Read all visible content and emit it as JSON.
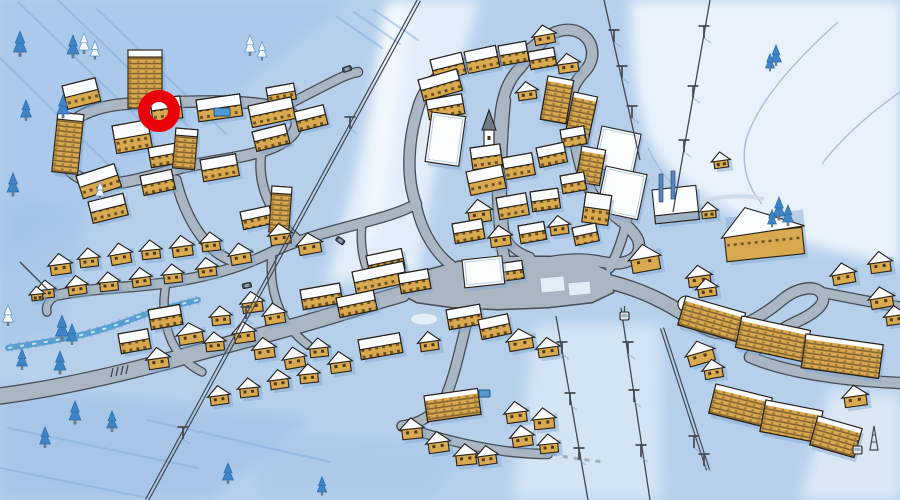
{
  "scene": {
    "width": 900,
    "height": 500,
    "kind": "illustrated-ski-resort-village-map"
  },
  "palette": {
    "snow_base": "#b6d0ec",
    "snow_light": "#e8f1fb",
    "snow_bright": "#f7fbff",
    "wash_dark": "#9fc1e6",
    "streak": "#84add9",
    "boundary": "#a2b8d0",
    "road_fill": "#aab6c2",
    "road_casing": "#41464d",
    "plaza_white": "#e2ecf5",
    "wall": "#d9a94f",
    "wall_dark": "#8a6426",
    "roof": "#fbfdff",
    "outline": "#262019",
    "shadow": "#7fa3cf",
    "window": "#4a3517",
    "floorline": "#47351a",
    "tree_blue": "#3d85c6",
    "tree_white": "#f4f9fe",
    "tree_edge": "#5b93c8",
    "water": "#4f9ad2",
    "water_bank": "#8d99a5",
    "lift": "#43474e",
    "post_blue": "#5585c2",
    "marker_red": "#e90008",
    "cone": "#e2a63e",
    "spire": "#707b88",
    "car": "#3e4a57"
  },
  "marker": {
    "cx": 159,
    "cy": 111,
    "ring_r": 15,
    "ring_w": 12
  },
  "washes": [
    {
      "d": "M620,0 H900 V265 C830,252 770,236 733,214 C697,192 668,176 652,146 C638,118 630,55 630,0 Z",
      "f": "#ecf4fc",
      "o": 0.95
    },
    {
      "d": "M388,0 H480 C462,62 444,120 434,178 C427,220 422,252 418,278 L326,284 C342,228 358,162 370,102 C376,66 383,30 388,0 Z",
      "f": "#e8f1fb",
      "o": 0.9
    },
    {
      "d": "M408,6 C402,70 392,150 380,220 L360,250 C370,170 380,80 386,6 Z",
      "f": "#f7fbff",
      "o": 0.8
    },
    {
      "d": "M535,325 L660,325 L662,500 L512,500 Z",
      "f": "#ddebf8",
      "o": 0.75
    },
    {
      "d": "M830,390 L900,395 L900,500 L800,500 Z",
      "f": "#e4eff9",
      "o": 0.8
    },
    {
      "d": "M0,0 L350,0 L140,170 L0,270 Z",
      "f": "#a4c5e9",
      "o": 0.6
    },
    {
      "d": "M0,195 L90,210 L60,330 L0,350 Z",
      "f": "#9fc1e6",
      "o": 0.5
    },
    {
      "d": "M0,385 L310,418 L210,500 L0,500 Z",
      "f": "#9cbfe4",
      "o": 0.55
    },
    {
      "d": "M250,432 L470,445 L430,500 L260,500 Z",
      "f": "#a5c6e8",
      "o": 0.5
    }
  ],
  "streaks": [
    [
      18,
      2,
      148,
      128
    ],
    [
      58,
      0,
      188,
      126
    ],
    [
      0,
      58,
      120,
      176
    ],
    [
      96,
      8,
      226,
      134
    ],
    [
      336,
      16,
      382,
      48
    ],
    [
      354,
      12,
      400,
      44
    ],
    [
      374,
      10,
      418,
      40
    ],
    [
      8,
      428,
      198,
      468
    ],
    [
      0,
      468,
      148,
      498
    ],
    [
      148,
      420,
      330,
      462
    ]
  ],
  "boundaries": [
    "M838,22 C800,56 758,100 746,140 C740,168 750,190 762,204",
    "M900,92 C866,116 840,140 822,164",
    "M648,148 C660,174 676,192 698,203"
  ],
  "river": {
    "d": "M198,300 C172,306 150,312 130,320 C104,330 80,336 56,340 C36,344 18,346 8,348"
  },
  "roads": [
    {
      "d": "M0,396 C60,388 130,372 200,352 C260,336 320,320 362,306 C380,300 392,297 402,294",
      "w": 15
    },
    {
      "d": "M62,142 C66,116 96,104 142,103 C188,102 242,98 280,108 C304,114 302,134 276,146 C250,158 212,160 180,168 C150,176 116,188 92,182 C70,177 57,160 62,142 Z",
      "w": 10
    },
    {
      "d": "M282,108 C300,98 320,88 338,79 C346,75 352,73 358,72",
      "w": 8
    },
    {
      "d": "M176,180 C182,204 192,226 206,242 C214,252 226,260 238,262",
      "w": 9
    },
    {
      "d": "M262,148 C258,170 262,190 272,208 C278,220 286,230 296,238",
      "w": 8
    },
    {
      "d": "M58,295 C90,288 130,288 165,283 C205,277 240,268 272,252 C302,238 332,231 362,223 C384,217 402,212 416,204",
      "w": 9
    },
    {
      "d": "M58,295 C50,299 45,305 47,312",
      "w": 7
    },
    {
      "d": "M166,284 C162,304 164,324 172,342 C179,356 190,366 202,372",
      "w": 7
    },
    {
      "d": "M272,252 C270,272 272,292 280,310 C286,324 296,336 308,345",
      "w": 7
    },
    {
      "d": "M362,223 C360,242 362,260 370,276",
      "w": 7
    },
    {
      "d": "M416,204 C406,178 408,140 418,108 C422,94 430,82 442,74",
      "w": 10
    },
    {
      "d": "M440,75 C464,62 488,56 510,56 C522,55 532,48 540,40",
      "w": 9
    },
    {
      "d": "M505,262 C498,230 495,160 500,120 C502,96 508,80 520,68 C528,58 535,50 542,42 C552,30 570,26 582,34 C595,43 595,60 585,71 C575,82 569,92 571,108 C574,140 579,170 591,192 C605,214 630,222 638,240 C644,258 626,267 602,262 C574,256 544,262 520,270",
      "w": 10
    },
    {
      "d": "M506,100 C502,140 500,190 504,230 C506,244 516,252 530,257",
      "w": 8
    },
    {
      "d": "M416,204 C422,234 438,258 458,270 C470,277 482,281 494,284",
      "w": 9
    },
    {
      "d": "M610,282 C642,290 666,302 690,318 C706,329 716,333 726,331",
      "w": 13
    },
    {
      "d": "M726,331 C750,324 768,312 782,300 C796,288 816,284 822,294 C828,304 812,315 796,322 C775,332 760,344 750,357",
      "w": 10
    },
    {
      "d": "M820,292 C845,297 870,302 900,307",
      "w": 9
    },
    {
      "d": "M750,357 C782,371 832,379 882,382 L900,383",
      "w": 10
    },
    {
      "d": "M610,268 C620,248 626,228 629,210",
      "w": 8
    },
    {
      "d": "M470,309 C462,340 456,372 446,396 C436,414 420,424 402,426",
      "w": 9
    },
    {
      "d": "M402,426 C430,436 468,446 504,451 C520,453 534,454 548,454",
      "w": 8
    }
  ],
  "plaza": {
    "d": "M398,292 L422,272 L458,262 L502,257 L548,257 L588,262 L610,272 L613,292 L592,302 L548,307 L498,309 L452,307 L417,302 Z"
  },
  "parking": [
    [
      540,
      278,
      24,
      15,
      -5
    ],
    [
      568,
      283,
      22,
      13,
      -5
    ]
  ],
  "island": {
    "cx": 424,
    "cy": 319,
    "rx": 13,
    "ry": 5.5
  },
  "trails": [
    {
      "d": "M552,454 C570,458 586,460 604,462",
      "s": "#98a5b1",
      "w": 3,
      "dash": "5 6",
      "o": 0.85
    },
    {
      "d": "M692,204 C718,196 744,194 764,199",
      "s": "#ccdae8",
      "w": 4,
      "dash": "",
      "o": 0.9
    }
  ],
  "ticks": [
    [
      113,
      368
    ],
    [
      118,
      367
    ],
    [
      123,
      366
    ],
    [
      128,
      365
    ]
  ],
  "lifts": [
    {
      "x1": 419,
      "y1": 0,
      "x2": 147,
      "y2": 500,
      "dbl": 1,
      "p": [
        [
          350,
          127
        ],
        [
          246,
          317
        ],
        [
          183,
          437
        ]
      ]
    },
    {
      "x1": 710,
      "y1": 0,
      "x2": 673,
      "y2": 212,
      "dbl": 0,
      "p": [
        [
          704,
          36
        ],
        [
          693,
          96
        ],
        [
          684,
          150
        ]
      ]
    },
    {
      "x1": 604,
      "y1": 0,
      "x2": 640,
      "y2": 160,
      "dbl": 0,
      "p": [
        [
          614,
          40
        ],
        [
          622,
          76
        ],
        [
          632,
          116
        ]
      ]
    },
    {
      "x1": 556,
      "y1": 316,
      "x2": 588,
      "y2": 500,
      "dbl": 0,
      "p": [
        [
          562,
          352
        ],
        [
          570,
          403
        ],
        [
          579,
          458
        ]
      ]
    },
    {
      "x1": 621,
      "y1": 308,
      "x2": 650,
      "y2": 500,
      "dbl": 0,
      "p": [
        [
          628,
          352
        ],
        [
          634,
          400
        ],
        [
          641,
          455
        ]
      ]
    },
    {
      "x1": 662,
      "y1": 328,
      "x2": 708,
      "y2": 470,
      "dbl": 1,
      "p": [
        [
          694,
          446
        ],
        [
          704,
          464
        ]
      ]
    },
    {
      "x1": 48,
      "y1": 290,
      "x2": 20,
      "y2": 262,
      "dbl": 0,
      "p": []
    }
  ],
  "posts": [
    [
      659,
      174
    ],
    [
      671,
      171
    ]
  ],
  "cabins": [
    [
      620,
      312
    ],
    [
      853,
      446
    ]
  ],
  "lattice": [
    [
      870,
      426
    ]
  ],
  "pools": [
    [
      214,
      108,
      16,
      8
    ],
    [
      479,
      390,
      11,
      7
    ]
  ],
  "cars": [
    [
      342,
      68,
      -18
    ],
    [
      338,
      236,
      35
    ],
    [
      242,
      284,
      -12
    ]
  ],
  "trees": [
    [
      20,
      52,
      2.2,
      "b"
    ],
    [
      73,
      54,
      2,
      "b"
    ],
    [
      84,
      50,
      1.8,
      "w"
    ],
    [
      95,
      56,
      1.6,
      "w"
    ],
    [
      250,
      52,
      1.8,
      "w"
    ],
    [
      262,
      57,
      1.6,
      "w"
    ],
    [
      63,
      114,
      2,
      "b"
    ],
    [
      26,
      117,
      1.8,
      "b"
    ],
    [
      13,
      192,
      2,
      "b"
    ],
    [
      100,
      196,
      1.5,
      "w"
    ],
    [
      8,
      322,
      1.8,
      "w"
    ],
    [
      22,
      366,
      1.8,
      "b"
    ],
    [
      60,
      370,
      2,
      "b"
    ],
    [
      62,
      336,
      2.2,
      "b"
    ],
    [
      72,
      341,
      1.8,
      "b"
    ],
    [
      45,
      444,
      1.8,
      "b"
    ],
    [
      75,
      420,
      2,
      "b"
    ],
    [
      112,
      428,
      1.8,
      "b"
    ],
    [
      228,
      480,
      1.8,
      "b"
    ],
    [
      322,
      492,
      1.6,
      "b"
    ],
    [
      776,
      62,
      1.8,
      "b"
    ],
    [
      770,
      68,
      1.5,
      "b"
    ],
    [
      779,
      216,
      2,
      "b"
    ],
    [
      788,
      222,
      1.8,
      "b"
    ],
    [
      772,
      224,
      1.5,
      "b"
    ]
  ],
  "buildings": [
    [
      128,
      50,
      34,
      58,
      0,
      "t"
    ],
    [
      62,
      86,
      34,
      24,
      -14,
      "b"
    ],
    [
      58,
      112,
      26,
      60,
      6,
      "t"
    ],
    [
      76,
      176,
      40,
      24,
      -18,
      "b"
    ],
    [
      88,
      202,
      36,
      22,
      -14,
      "b"
    ],
    [
      112,
      126,
      36,
      28,
      -10,
      "b"
    ],
    [
      148,
      148,
      30,
      20,
      -10,
      "b"
    ],
    [
      176,
      128,
      22,
      40,
      5,
      "t"
    ],
    [
      140,
      176,
      32,
      20,
      -12,
      "b"
    ],
    [
      200,
      160,
      36,
      22,
      -10,
      "b"
    ],
    [
      196,
      100,
      44,
      22,
      -8,
      "b"
    ],
    [
      150,
      100,
      30,
      22,
      -8,
      "b"
    ],
    [
      248,
      106,
      44,
      22,
      -12,
      "b"
    ],
    [
      252,
      132,
      34,
      20,
      -14,
      "b"
    ],
    [
      266,
      88,
      28,
      16,
      -10,
      "b"
    ],
    [
      294,
      112,
      30,
      20,
      -14,
      "b"
    ],
    [
      272,
      186,
      20,
      46,
      4,
      "t"
    ],
    [
      240,
      212,
      30,
      18,
      -12,
      "b"
    ],
    [
      268,
      228,
      22,
      18,
      -8,
      "c"
    ],
    [
      296,
      238,
      24,
      18,
      -10,
      "c"
    ],
    [
      48,
      258,
      22,
      18,
      -8,
      "c"
    ],
    [
      78,
      252,
      20,
      16,
      -6,
      "c"
    ],
    [
      108,
      248,
      22,
      18,
      -10,
      "c"
    ],
    [
      140,
      244,
      20,
      16,
      -6,
      "c"
    ],
    [
      170,
      240,
      22,
      18,
      -8,
      "c"
    ],
    [
      200,
      236,
      20,
      16,
      -6,
      "c"
    ],
    [
      228,
      248,
      22,
      18,
      -10,
      "c"
    ],
    [
      36,
      284,
      18,
      15,
      -6,
      "c"
    ],
    [
      66,
      280,
      20,
      16,
      -8,
      "c"
    ],
    [
      98,
      276,
      20,
      16,
      -6,
      "c"
    ],
    [
      130,
      272,
      20,
      16,
      -8,
      "c"
    ],
    [
      162,
      268,
      20,
      16,
      -6,
      "c"
    ],
    [
      196,
      262,
      20,
      16,
      -8,
      "c"
    ],
    [
      30,
      290,
      13,
      11,
      -6,
      "c"
    ],
    [
      352,
      272,
      52,
      22,
      -12,
      "b"
    ],
    [
      300,
      290,
      40,
      20,
      -10,
      "b"
    ],
    [
      336,
      298,
      38,
      20,
      -12,
      "b"
    ],
    [
      358,
      340,
      42,
      20,
      -10,
      "b"
    ],
    [
      366,
      256,
      36,
      20,
      -12,
      "b"
    ],
    [
      398,
      274,
      30,
      20,
      -10,
      "b"
    ],
    [
      240,
      296,
      22,
      18,
      -8,
      "c"
    ],
    [
      262,
      308,
      22,
      18,
      -10,
      "c"
    ],
    [
      232,
      326,
      22,
      18,
      -8,
      "c"
    ],
    [
      204,
      336,
      20,
      16,
      -6,
      "c"
    ],
    [
      148,
      310,
      32,
      20,
      -10,
      "b"
    ],
    [
      118,
      334,
      30,
      20,
      -10,
      "b"
    ],
    [
      176,
      328,
      26,
      18,
      -10,
      "c"
    ],
    [
      146,
      352,
      22,
      18,
      -8,
      "c"
    ],
    [
      252,
      342,
      22,
      18,
      -8,
      "c"
    ],
    [
      282,
      352,
      22,
      18,
      -10,
      "c"
    ],
    [
      308,
      342,
      20,
      16,
      -6,
      "c"
    ],
    [
      328,
      356,
      22,
      18,
      -8,
      "c"
    ],
    [
      298,
      368,
      20,
      16,
      -6,
      "c"
    ],
    [
      268,
      374,
      20,
      16,
      -8,
      "c"
    ],
    [
      238,
      382,
      20,
      16,
      -6,
      "c"
    ],
    [
      208,
      390,
      20,
      16,
      -8,
      "c"
    ],
    [
      210,
      310,
      20,
      16,
      -6,
      "c"
    ],
    [
      446,
      310,
      34,
      20,
      -10,
      "b"
    ],
    [
      478,
      320,
      30,
      20,
      -12,
      "b"
    ],
    [
      418,
      336,
      20,
      16,
      -8,
      "c"
    ],
    [
      506,
      334,
      26,
      18,
      -10,
      "c"
    ],
    [
      536,
      342,
      22,
      16,
      -8,
      "c"
    ],
    [
      424,
      396,
      54,
      26,
      -8,
      "l"
    ],
    [
      400,
      422,
      22,
      18,
      -6,
      "c"
    ],
    [
      426,
      436,
      22,
      18,
      -8,
      "c"
    ],
    [
      454,
      448,
      22,
      18,
      -6,
      "c"
    ],
    [
      504,
      406,
      22,
      18,
      -8,
      "c"
    ],
    [
      532,
      412,
      22,
      18,
      -6,
      "c"
    ],
    [
      510,
      430,
      22,
      18,
      -8,
      "c"
    ],
    [
      538,
      438,
      20,
      16,
      -6,
      "c"
    ],
    [
      476,
      450,
      20,
      16,
      -8,
      "c"
    ],
    [
      430,
      60,
      32,
      22,
      -14,
      "b"
    ],
    [
      464,
      52,
      32,
      22,
      -12,
      "b"
    ],
    [
      498,
      46,
      28,
      20,
      -10,
      "b"
    ],
    [
      528,
      52,
      26,
      18,
      -10,
      "b"
    ],
    [
      556,
      58,
      22,
      16,
      -8,
      "c"
    ],
    [
      532,
      30,
      22,
      16,
      -10,
      "c"
    ],
    [
      418,
      80,
      40,
      22,
      -16,
      "b"
    ],
    [
      426,
      100,
      36,
      20,
      -10,
      "b"
    ],
    [
      432,
      112,
      34,
      50,
      8,
      "h"
    ],
    [
      482,
      116,
      14,
      44,
      0,
      "ch"
    ],
    [
      470,
      148,
      30,
      22,
      -8,
      "b"
    ],
    [
      466,
      172,
      36,
      24,
      -12,
      "b"
    ],
    [
      502,
      158,
      30,
      22,
      -10,
      "b"
    ],
    [
      536,
      148,
      28,
      20,
      -12,
      "b"
    ],
    [
      560,
      130,
      24,
      18,
      -10,
      "b"
    ],
    [
      466,
      204,
      24,
      20,
      -8,
      "c"
    ],
    [
      496,
      198,
      30,
      22,
      -10,
      "b"
    ],
    [
      530,
      192,
      28,
      20,
      -8,
      "b"
    ],
    [
      548,
      76,
      26,
      44,
      10,
      "l"
    ],
    [
      574,
      92,
      24,
      48,
      12,
      "l"
    ],
    [
      582,
      146,
      24,
      36,
      10,
      "l"
    ],
    [
      586,
      192,
      26,
      30,
      8,
      "b"
    ],
    [
      560,
      176,
      24,
      18,
      -10,
      "b"
    ],
    [
      452,
      224,
      30,
      20,
      -10,
      "b"
    ],
    [
      488,
      230,
      22,
      18,
      -8,
      "c"
    ],
    [
      518,
      226,
      26,
      18,
      -10,
      "b"
    ],
    [
      548,
      220,
      20,
      16,
      -8,
      "c"
    ],
    [
      572,
      228,
      24,
      18,
      -12,
      "b"
    ],
    [
      516,
      86,
      20,
      15,
      -8,
      "c"
    ],
    [
      462,
      260,
      40,
      28,
      -6,
      "h"
    ],
    [
      496,
      264,
      26,
      18,
      -8,
      "b"
    ],
    [
      602,
      126,
      40,
      42,
      12,
      "h"
    ],
    [
      606,
      166,
      42,
      46,
      12,
      "h"
    ],
    [
      612,
      180,
      14,
      20,
      12,
      "b"
    ],
    [
      652,
      190,
      44,
      34,
      -6,
      "s"
    ],
    [
      700,
      206,
      16,
      13,
      -6,
      "c"
    ],
    [
      712,
      156,
      16,
      13,
      -8,
      "c"
    ],
    [
      722,
      214,
      78,
      48,
      -6,
      "A"
    ],
    [
      729,
      226,
      16,
      24,
      0,
      "k"
    ],
    [
      628,
      250,
      30,
      24,
      -10,
      "c"
    ],
    [
      686,
      270,
      24,
      18,
      -8,
      "c"
    ],
    [
      830,
      268,
      24,
      18,
      -10,
      "c"
    ],
    [
      868,
      256,
      22,
      18,
      -8,
      "c"
    ],
    [
      868,
      292,
      24,
      18,
      -10,
      "c"
    ],
    [
      884,
      310,
      20,
      16,
      -8,
      "c"
    ],
    [
      696,
      283,
      20,
      15,
      -8,
      "c"
    ],
    [
      686,
      296,
      62,
      30,
      16,
      "l"
    ],
    [
      742,
      316,
      70,
      32,
      12,
      "l"
    ],
    [
      806,
      334,
      78,
      34,
      8,
      "l"
    ],
    [
      716,
      384,
      58,
      30,
      14,
      "l"
    ],
    [
      766,
      400,
      58,
      32,
      11,
      "l"
    ],
    [
      818,
      416,
      46,
      30,
      16,
      "l"
    ],
    [
      842,
      390,
      24,
      18,
      -8,
      "c"
    ],
    [
      684,
      348,
      28,
      20,
      -16,
      "c"
    ],
    [
      702,
      364,
      20,
      16,
      -10,
      "c"
    ],
    [
      678,
      296,
      16,
      16,
      0,
      "d"
    ]
  ]
}
